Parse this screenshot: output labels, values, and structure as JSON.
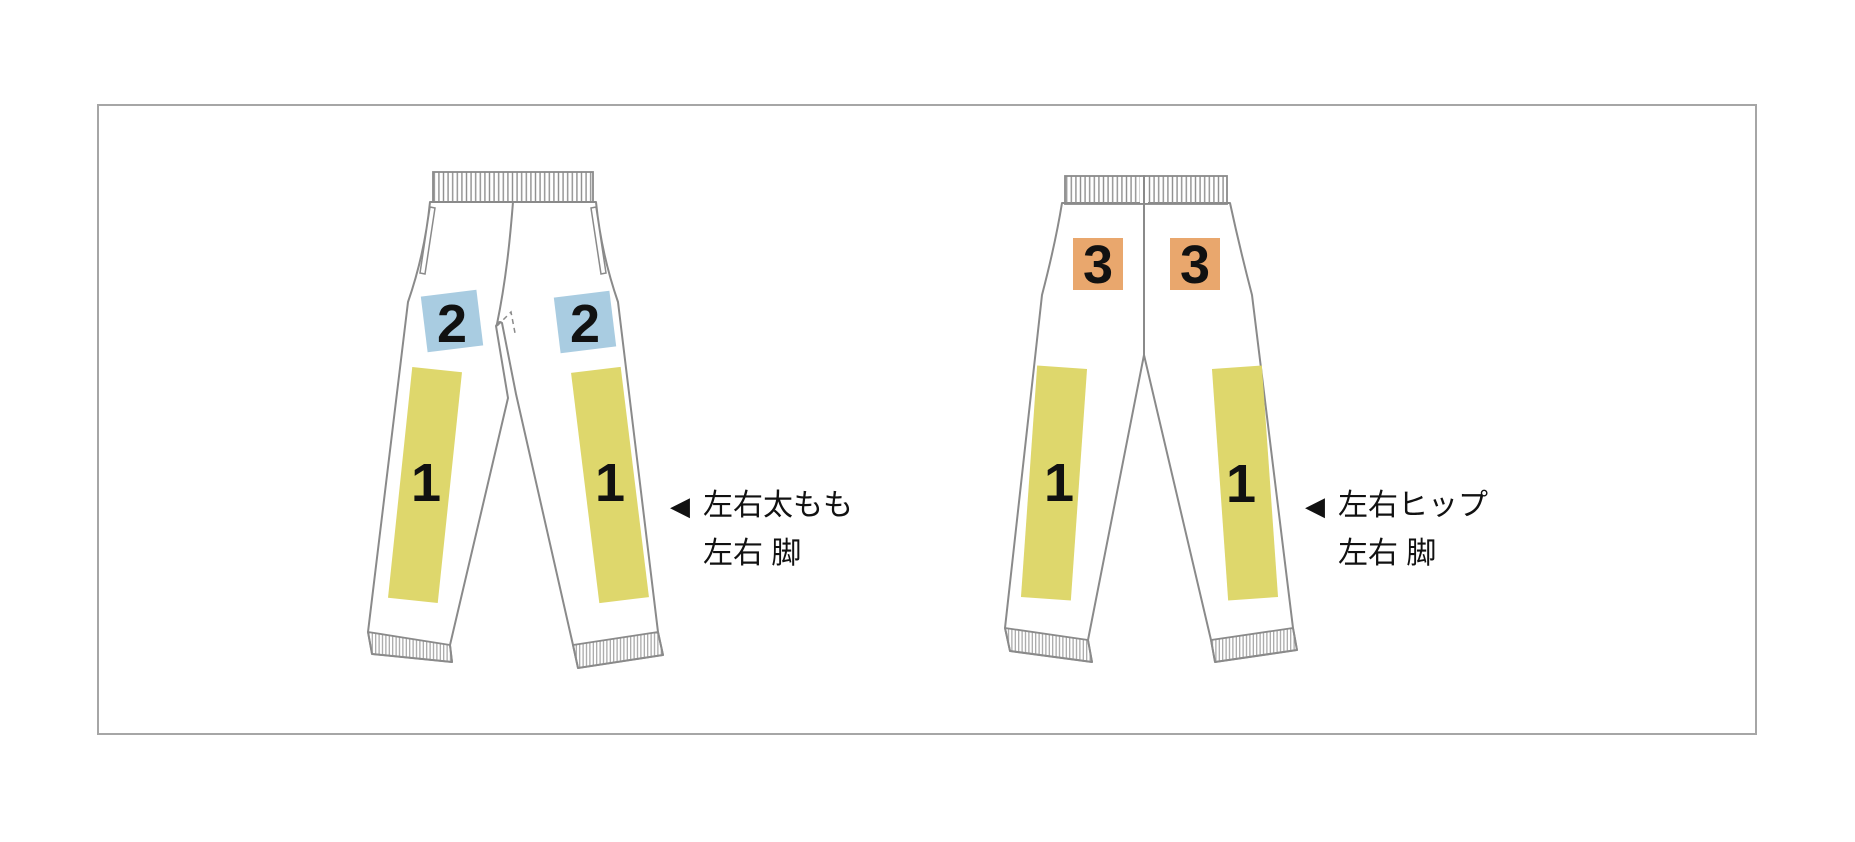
{
  "colors": {
    "zone_leg": "#ded76c",
    "zone_thigh": "#a9cce1",
    "zone_hip": "#e9a76d",
    "outline_gray": "#8a8a8a",
    "frame_border": "#a6a6a6",
    "label_text": "#111111"
  },
  "front_view": {
    "zones": {
      "left_thigh": {
        "label": "2"
      },
      "right_thigh": {
        "label": "2"
      },
      "left_leg": {
        "label": "1"
      },
      "right_leg": {
        "label": "1"
      }
    },
    "annotation": {
      "arrow": "◀",
      "line1": "左右太もも",
      "line2": "左右 脚"
    }
  },
  "back_view": {
    "zones": {
      "left_hip": {
        "label": "3"
      },
      "right_hip": {
        "label": "3"
      },
      "left_leg": {
        "label": "1"
      },
      "right_leg": {
        "label": "1"
      }
    },
    "annotation": {
      "arrow": "◀",
      "line1": "左右ヒップ",
      "line2": "左右 脚"
    }
  }
}
